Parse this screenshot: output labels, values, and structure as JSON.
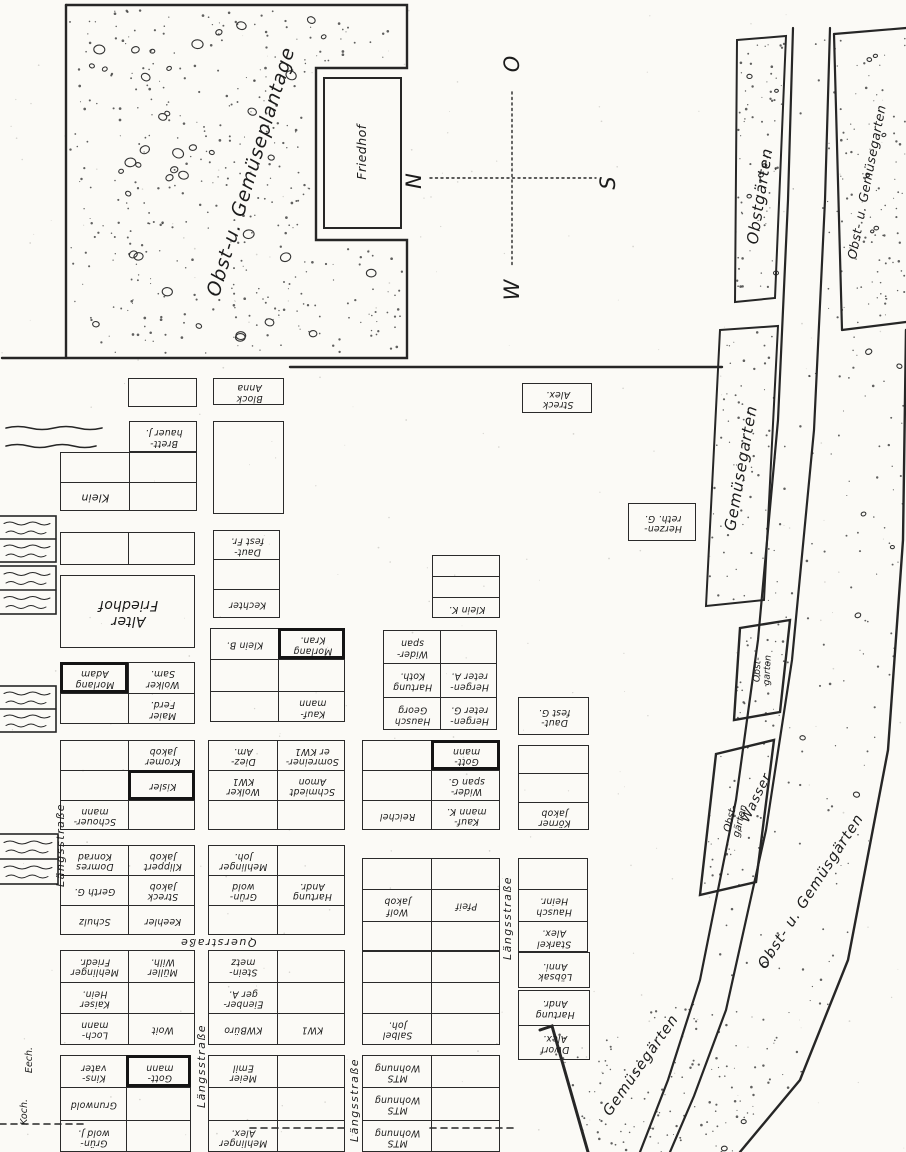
{
  "compass": {
    "north": "N",
    "east": "O",
    "south": "S",
    "west": "W"
  },
  "areas": {
    "plantage": "Obst-u. Gemüseplantage",
    "friedhof": "Friedhof",
    "obstgaerten": "Obstgärten",
    "obst_u_gemuesegarten": "Obst- u. Gemüsegarten",
    "gemuesegarten": "Gemüsegarten",
    "obstgarten_1": "Obst-\ngarten",
    "obstgarten_2": "Obst-\ngärten",
    "wasser": "Wasser",
    "obst_u_gemuesgaerten": "Obst- u. Gemüsgärten",
    "gemuesegaerten_unten": "Gemüsegärten"
  },
  "streets": [
    "Längsstraße",
    "Längsstraße",
    "Längsstraße",
    "Längsstraße",
    "Querstraße"
  ],
  "edge_labels": [
    "Eech.",
    "Koch."
  ],
  "blocks": [
    {
      "x": 128,
      "y": 378,
      "w": 69,
      "h": 29,
      "cols": 1,
      "rows": [
        [
          ""
        ]
      ]
    },
    {
      "x": 213,
      "y": 378,
      "w": 71,
      "h": 27,
      "cols": 1,
      "rows": [
        [
          "Block\nAnna"
        ]
      ]
    },
    {
      "x": 129,
      "y": 421,
      "w": 68,
      "h": 31,
      "cols": 1,
      "rows": [
        [
          "Brett-\nhauer J."
        ]
      ]
    },
    {
      "x": 60,
      "y": 452,
      "w": 137,
      "h": 59,
      "cols": 2,
      "rows": [
        [
          "",
          ""
        ],
        [
          {
            "t": "Klein",
            "fs": 11
          },
          ""
        ]
      ]
    },
    {
      "x": 213,
      "y": 421,
      "w": 71,
      "h": 93,
      "cols": 1,
      "rows": [
        [
          ""
        ]
      ]
    },
    {
      "x": 60,
      "y": 532,
      "w": 135,
      "h": 33,
      "cols": 2,
      "rows": [
        [
          "",
          ""
        ]
      ]
    },
    {
      "x": 213,
      "y": 530,
      "w": 67,
      "h": 88,
      "cols": 1,
      "rows": [
        [
          "Daut-\nfest Fr."
        ],
        [
          ""
        ],
        [
          "Kechter"
        ]
      ]
    },
    {
      "x": 60,
      "y": 575,
      "w": 135,
      "h": 73,
      "cols": 1,
      "rows": [
        [
          {
            "t": "Alter\nFriedhof",
            "fs": 14
          }
        ]
      ]
    },
    {
      "x": 432,
      "y": 555,
      "w": 68,
      "h": 63,
      "cols": 1,
      "rows": [
        [
          ""
        ],
        [
          ""
        ],
        [
          "Klein K."
        ]
      ]
    },
    {
      "x": 522,
      "y": 383,
      "w": 70,
      "h": 30,
      "cols": 1,
      "rows": [
        [
          "Streck\nAlex."
        ]
      ]
    },
    {
      "x": 628,
      "y": 503,
      "w": 68,
      "h": 38,
      "cols": 1,
      "rows": [
        [
          "Herzen-\nreth. G."
        ]
      ]
    },
    {
      "x": 60,
      "y": 662,
      "w": 135,
      "h": 62,
      "cols": 2,
      "rows": [
        [
          {
            "t": "Morlang\nAdam",
            "b": true
          },
          "Wolker\nSam."
        ],
        [
          "",
          "Maier\nFerd."
        ]
      ]
    },
    {
      "x": 210,
      "y": 628,
      "w": 135,
      "h": 94,
      "cols": 2,
      "rows": [
        [
          "Klein B.",
          {
            "t": "Morlang\nKran.",
            "b": true
          }
        ],
        [
          "",
          ""
        ],
        [
          "",
          "Kauf-\nmann"
        ]
      ]
    },
    {
      "x": 383,
      "y": 630,
      "w": 114,
      "h": 100,
      "cols": 2,
      "rows": [
        [
          "Wider-\nspan",
          ""
        ],
        [
          "Hartung\nKoth.",
          "Hergen-\nreter A."
        ],
        [
          "Hausch\nGeorg",
          "Hergen-\nreter G."
        ]
      ]
    },
    {
      "x": 518,
      "y": 697,
      "w": 71,
      "h": 38,
      "cols": 1,
      "rows": [
        [
          "Daut-\nfest G."
        ]
      ]
    },
    {
      "x": 60,
      "y": 740,
      "w": 135,
      "h": 90,
      "cols": 2,
      "rows": [
        [
          "",
          "Kromer\nJakob"
        ],
        [
          "",
          {
            "t": "Kisler",
            "b": true
          }
        ],
        [
          "Schouer-\nmann",
          ""
        ]
      ]
    },
    {
      "x": 208,
      "y": 740,
      "w": 137,
      "h": 90,
      "cols": 2,
      "rows": [
        [
          "Diez-\nAm.",
          "Somreiner-\ner KW1"
        ],
        [
          "Wolker\nKW1",
          "Schmiedt\nAmon"
        ],
        [
          "",
          ""
        ]
      ]
    },
    {
      "x": 362,
      "y": 740,
      "w": 138,
      "h": 90,
      "cols": 2,
      "rows": [
        [
          "",
          {
            "t": "Gott-\nmann",
            "b": true
          }
        ],
        [
          "",
          "Wider-\nspan G."
        ],
        [
          "Reichel",
          "Kauf-\nmann K."
        ]
      ]
    },
    {
      "x": 518,
      "y": 745,
      "w": 71,
      "h": 85,
      "cols": 1,
      "rows": [
        [
          ""
        ],
        [
          ""
        ],
        [
          "Körner\nJakob"
        ]
      ]
    },
    {
      "x": 60,
      "y": 845,
      "w": 135,
      "h": 90,
      "cols": 2,
      "rows": [
        [
          "Domres\nKonrad",
          "Klippert\nJakob"
        ],
        [
          "Gerth G.",
          "Streck\nJakob"
        ],
        [
          "Schulz",
          "Keehler"
        ]
      ]
    },
    {
      "x": 208,
      "y": 845,
      "w": 137,
      "h": 90,
      "cols": 2,
      "rows": [
        [
          "Mehlinger\nJoh.",
          ""
        ],
        [
          "Grün-\nwold",
          "Hartung\nAndr."
        ],
        [
          "",
          ""
        ]
      ]
    },
    {
      "x": 362,
      "y": 858,
      "w": 138,
      "h": 94,
      "cols": 2,
      "rows": [
        [
          "",
          ""
        ],
        [
          "Wolf\nJakob",
          "Pfeif"
        ],
        [
          "",
          ""
        ]
      ]
    },
    {
      "x": 518,
      "y": 858,
      "w": 70,
      "h": 94,
      "cols": 1,
      "rows": [
        [
          ""
        ],
        [
          "Hausch\nHeinr."
        ],
        [
          "Starkel\nAlex."
        ]
      ]
    },
    {
      "x": 60,
      "y": 950,
      "w": 135,
      "h": 95,
      "cols": 2,
      "rows": [
        [
          "Mehlinger\nFriedr.",
          "Müller\nWilh."
        ],
        [
          "Kaiser\nHein.",
          ""
        ],
        [
          "Loch-\nmann",
          "Woit"
        ]
      ]
    },
    {
      "x": 208,
      "y": 950,
      "w": 137,
      "h": 95,
      "cols": 2,
      "rows": [
        [
          "Stein-\nmetz",
          ""
        ],
        [
          "Eienber-\nger A.",
          ""
        ],
        [
          "KWBüro",
          "KW1"
        ]
      ]
    },
    {
      "x": 362,
      "y": 950,
      "w": 138,
      "h": 95,
      "cols": 2,
      "rows": [
        [
          "",
          ""
        ],
        [
          "",
          ""
        ],
        [
          "Salbel\nJoh.",
          ""
        ]
      ]
    },
    {
      "x": 518,
      "y": 952,
      "w": 72,
      "h": 36,
      "cols": 1,
      "rows": [
        [
          "Löbsak\nAnni."
        ]
      ]
    },
    {
      "x": 518,
      "y": 990,
      "w": 72,
      "h": 70,
      "cols": 1,
      "rows": [
        [
          "Hartung\nAndr."
        ],
        [
          "Dworf\nAlex."
        ]
      ]
    },
    {
      "x": 60,
      "y": 1055,
      "w": 131,
      "h": 97,
      "cols": 2,
      "rows": [
        [
          "Kins-\nvater",
          {
            "t": "Gott-\nmann",
            "b": true
          }
        ],
        [
          "Grunwold",
          ""
        ],
        [
          "Grün-\nwold J.",
          ""
        ]
      ]
    },
    {
      "x": 208,
      "y": 1055,
      "w": 137,
      "h": 97,
      "cols": 2,
      "rows": [
        [
          "Meier\nEmil",
          ""
        ],
        [
          "",
          ""
        ],
        [
          "Mehlinger\nAlex.",
          ""
        ]
      ]
    },
    {
      "x": 362,
      "y": 1055,
      "w": 138,
      "h": 97,
      "cols": 2,
      "rows": [
        [
          "MTS\nWohnung",
          ""
        ],
        [
          "MTS\nWohnung",
          ""
        ],
        [
          "MTS\nWohnung",
          ""
        ]
      ]
    }
  ]
}
